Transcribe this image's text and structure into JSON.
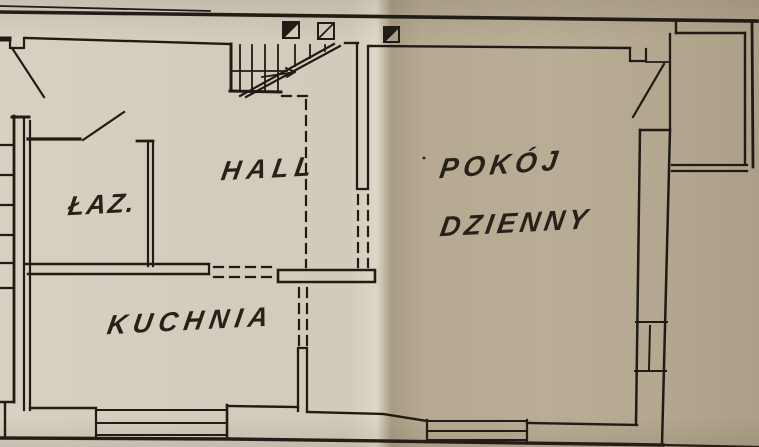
{
  "rooms": {
    "bathroom": {
      "label": "ŁAZ."
    },
    "hall": {
      "label": "HALL"
    },
    "kitchen": {
      "label": "KUCHNIA"
    },
    "living_room": {
      "line1": "POKÓJ",
      "line2": "DZIENNY"
    }
  },
  "features": {
    "stairs": "stairs-with-up-arrow",
    "flue_symbols": [
      "flue-symbol-filled",
      "flue-symbol-open",
      "flue-symbol-filled"
    ],
    "doors": [
      "entrance-door-swing",
      "bathroom-door-swing",
      "living-room-door-swing"
    ],
    "windows": [
      "kitchen-south-window",
      "living-room-south-window",
      "living-room-east-window"
    ],
    "dashed_lines": "dashed-wall-opening-lines",
    "paper": "vertical-paper-fold"
  },
  "colors": {
    "paper_light": "#d3ccbd",
    "paper_dark": "#b5a991",
    "ink": "#201b15"
  }
}
